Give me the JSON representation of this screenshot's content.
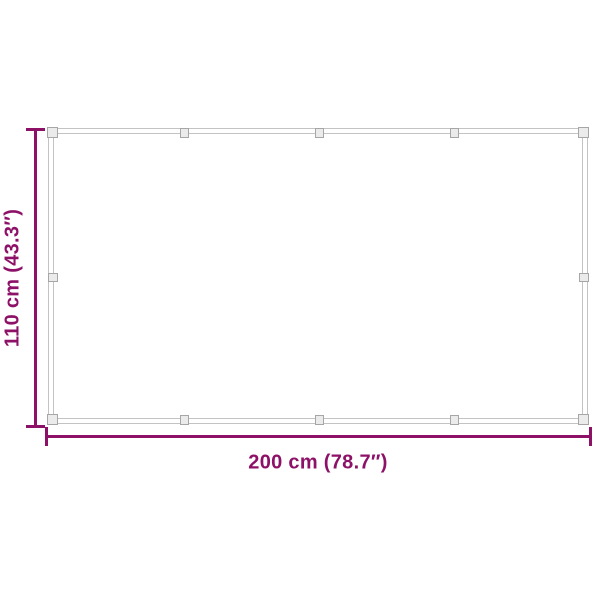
{
  "diagram": {
    "type": "product-dimension-diagram",
    "subject": "rectangular tarp/net frame with edge connectors"
  },
  "dimensions": {
    "height_label": "110 cm (43.3″)",
    "width_label": "200 cm (78.7″)"
  },
  "colors": {
    "dimension_accent": "#8E1168",
    "frame_line": "#C3C3C3",
    "connector_border": "#A6A6A6",
    "connector_fill": "#EBEBEB",
    "background": "#FFFFFF"
  }
}
